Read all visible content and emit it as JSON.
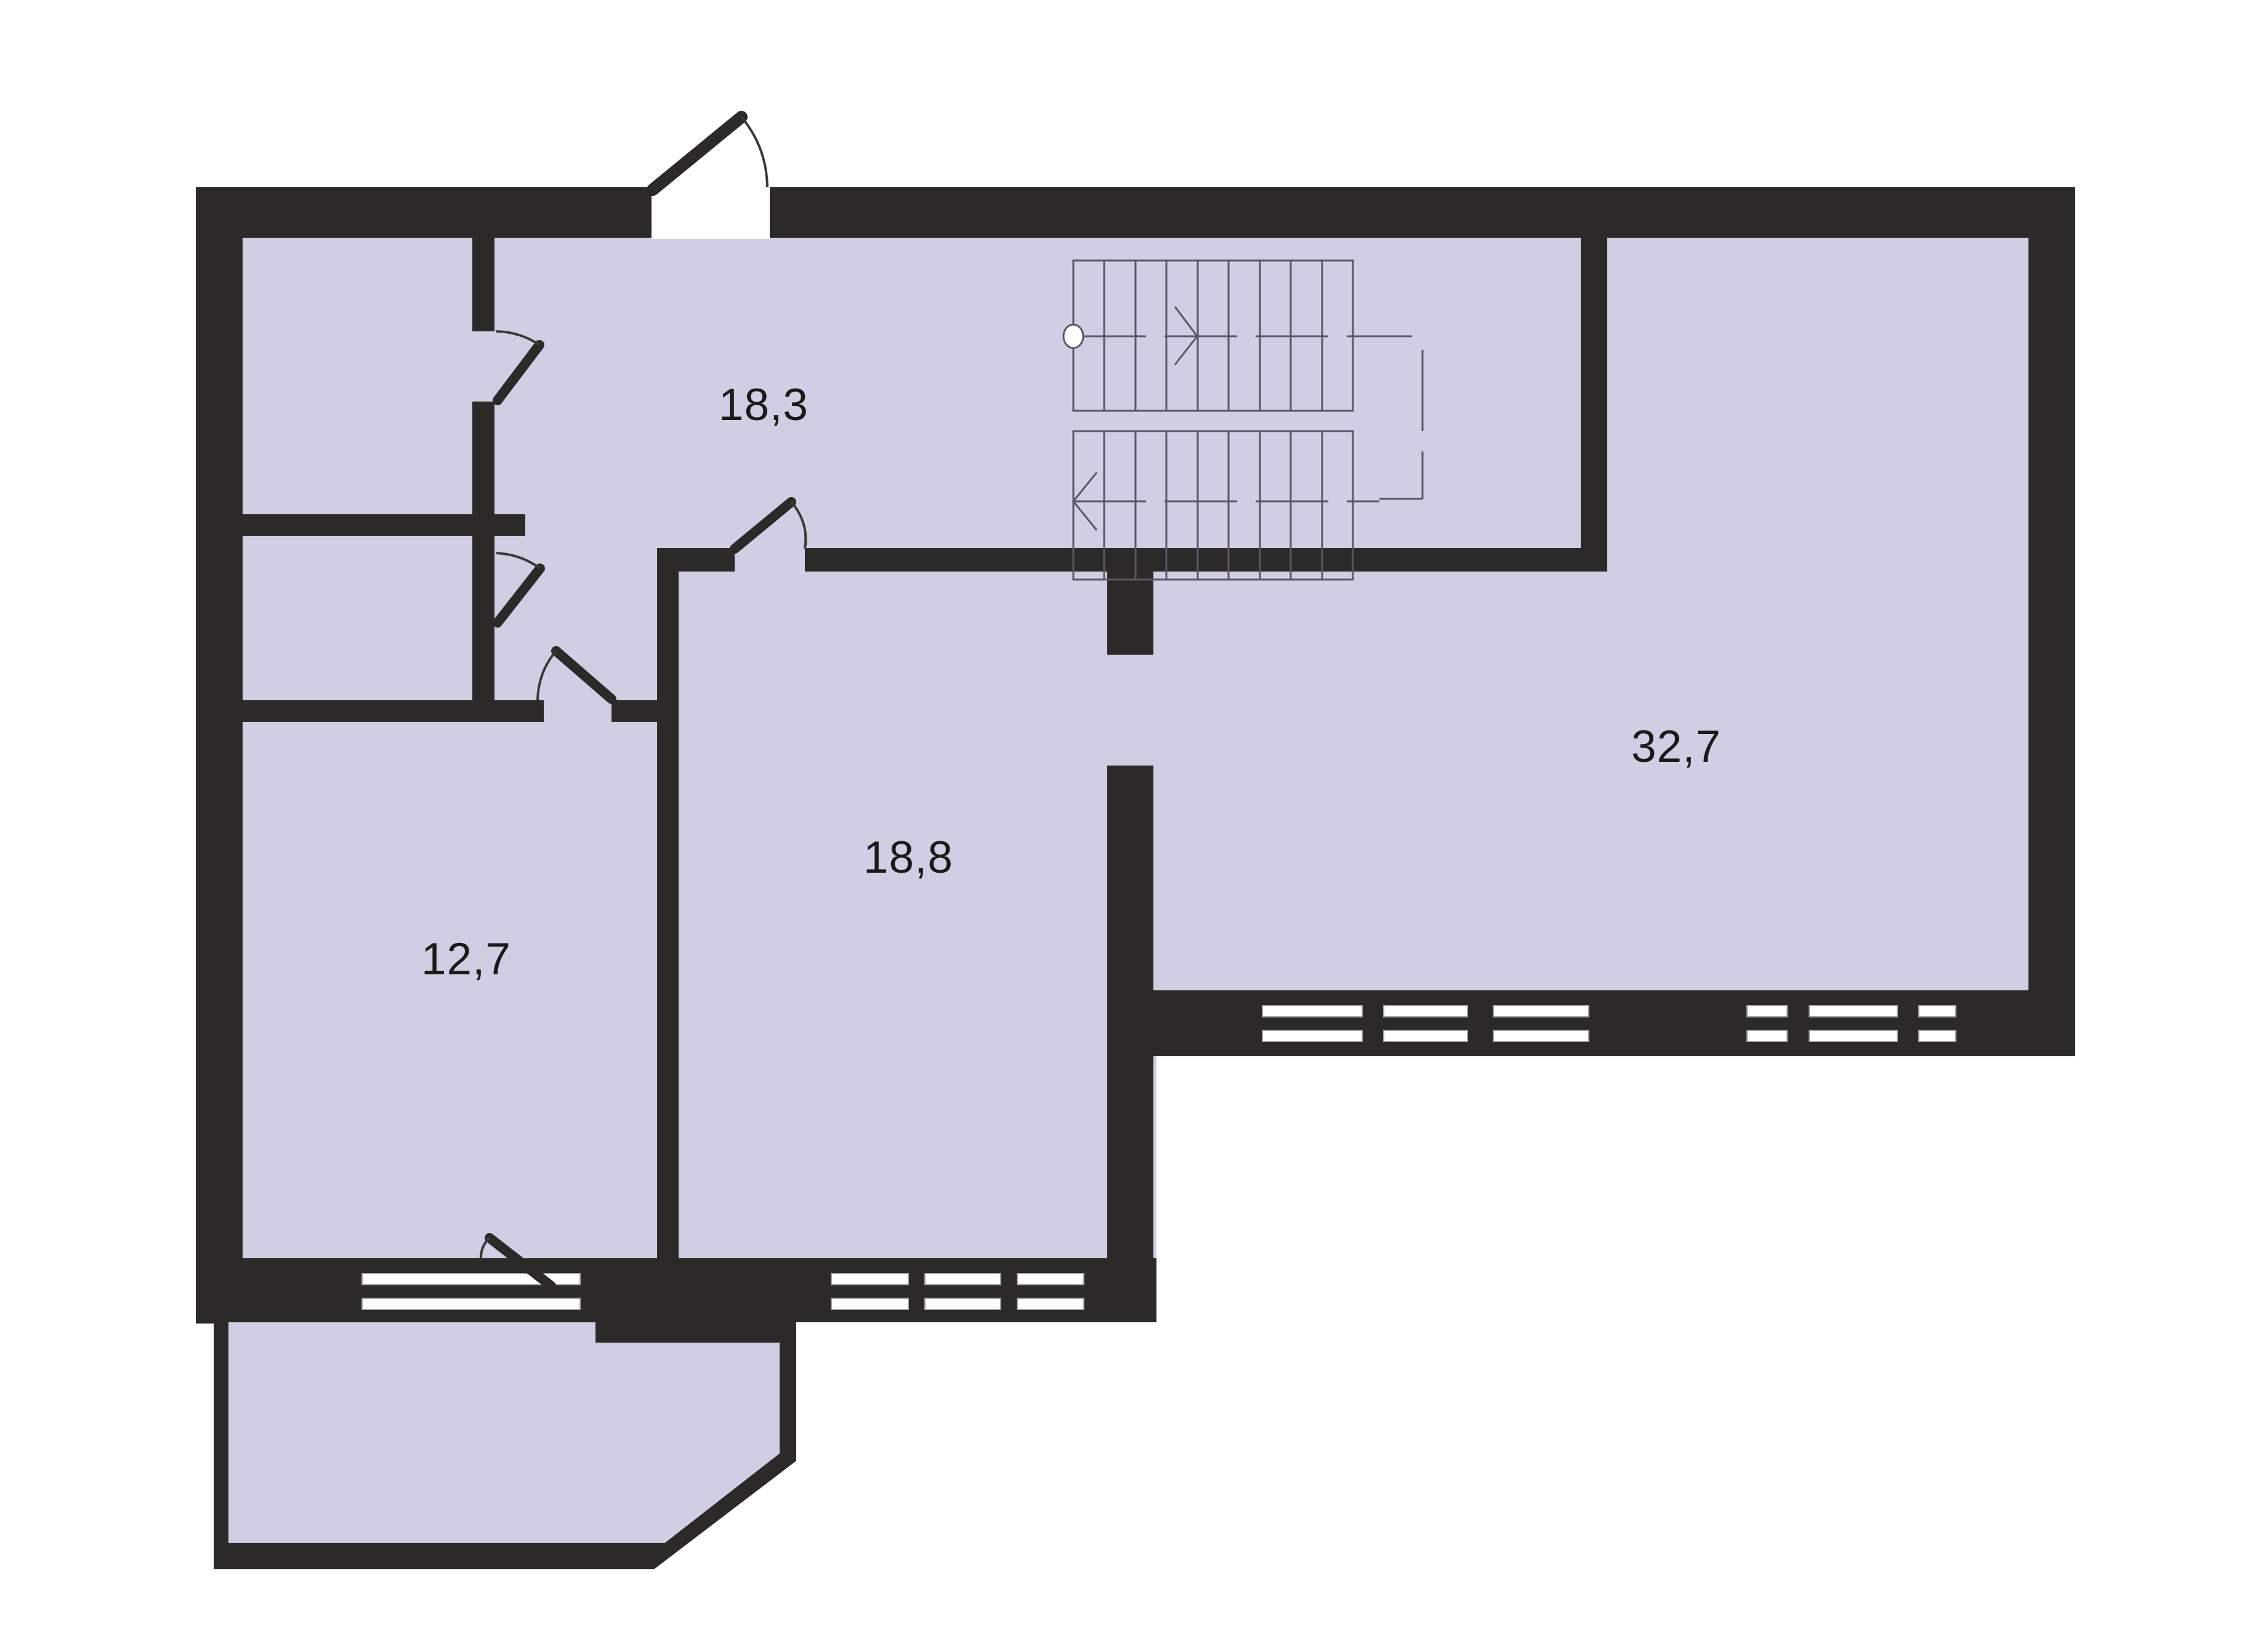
{
  "rooms": [
    {
      "id": "hall",
      "area_label": "18,3"
    },
    {
      "id": "room-large",
      "area_label": "32,7"
    },
    {
      "id": "room-middle",
      "area_label": "18,8"
    },
    {
      "id": "room-small",
      "area_label": "12,7"
    }
  ],
  "stairs": {
    "flights": 2,
    "treads_per_flight": 9,
    "upper_arrow": "right",
    "lower_arrow": "left"
  },
  "colors": {
    "wall": "#2b2a29",
    "floor": "#d1cee3",
    "background": "#ffffff",
    "line": "#5a5665",
    "ink": "#1a1a1a",
    "window": "#ffffff",
    "window_border": "#a5a2b0"
  }
}
